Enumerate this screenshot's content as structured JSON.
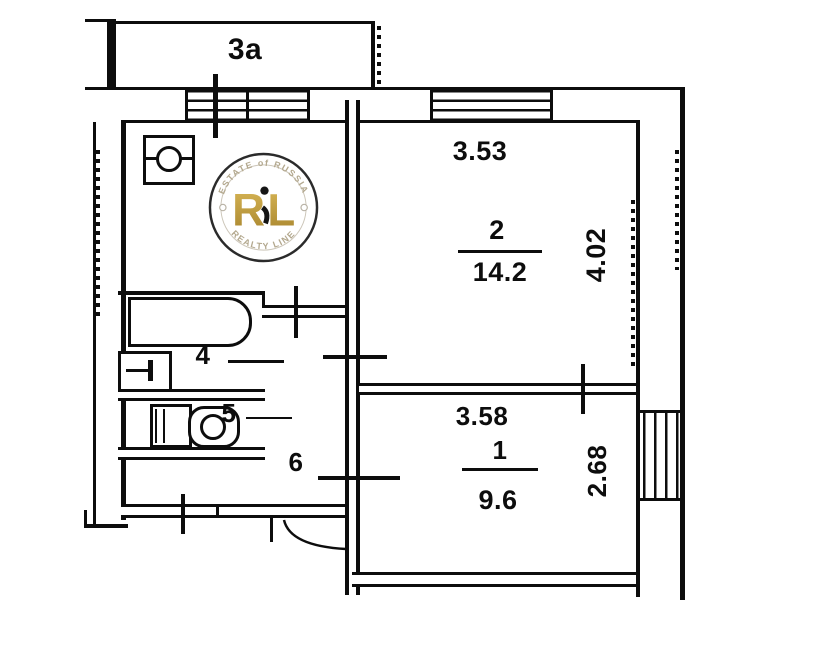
{
  "balcony": {
    "label": "3а"
  },
  "room2": {
    "number": "2",
    "area": "14.2",
    "width_dim": "3.53",
    "depth_dim": "4.02"
  },
  "room1": {
    "number": "1",
    "area": "9.6",
    "width_dim": "3.58",
    "depth_dim": "2.68"
  },
  "bathroom": {
    "number": "4"
  },
  "toilet": {
    "number": "5"
  },
  "hallway": {
    "number": "6"
  },
  "logo": {
    "arc_top": "ESTATE of RUSSIA",
    "monogram_left": "R",
    "monogram_right": "L",
    "arc_bottom": "REALTY LINE",
    "gold_color": "#bd9a3e",
    "arc_text_color": "#b3a88e"
  },
  "colors": {
    "ink": "#0d0d0d",
    "paper": "#ffffff"
  }
}
